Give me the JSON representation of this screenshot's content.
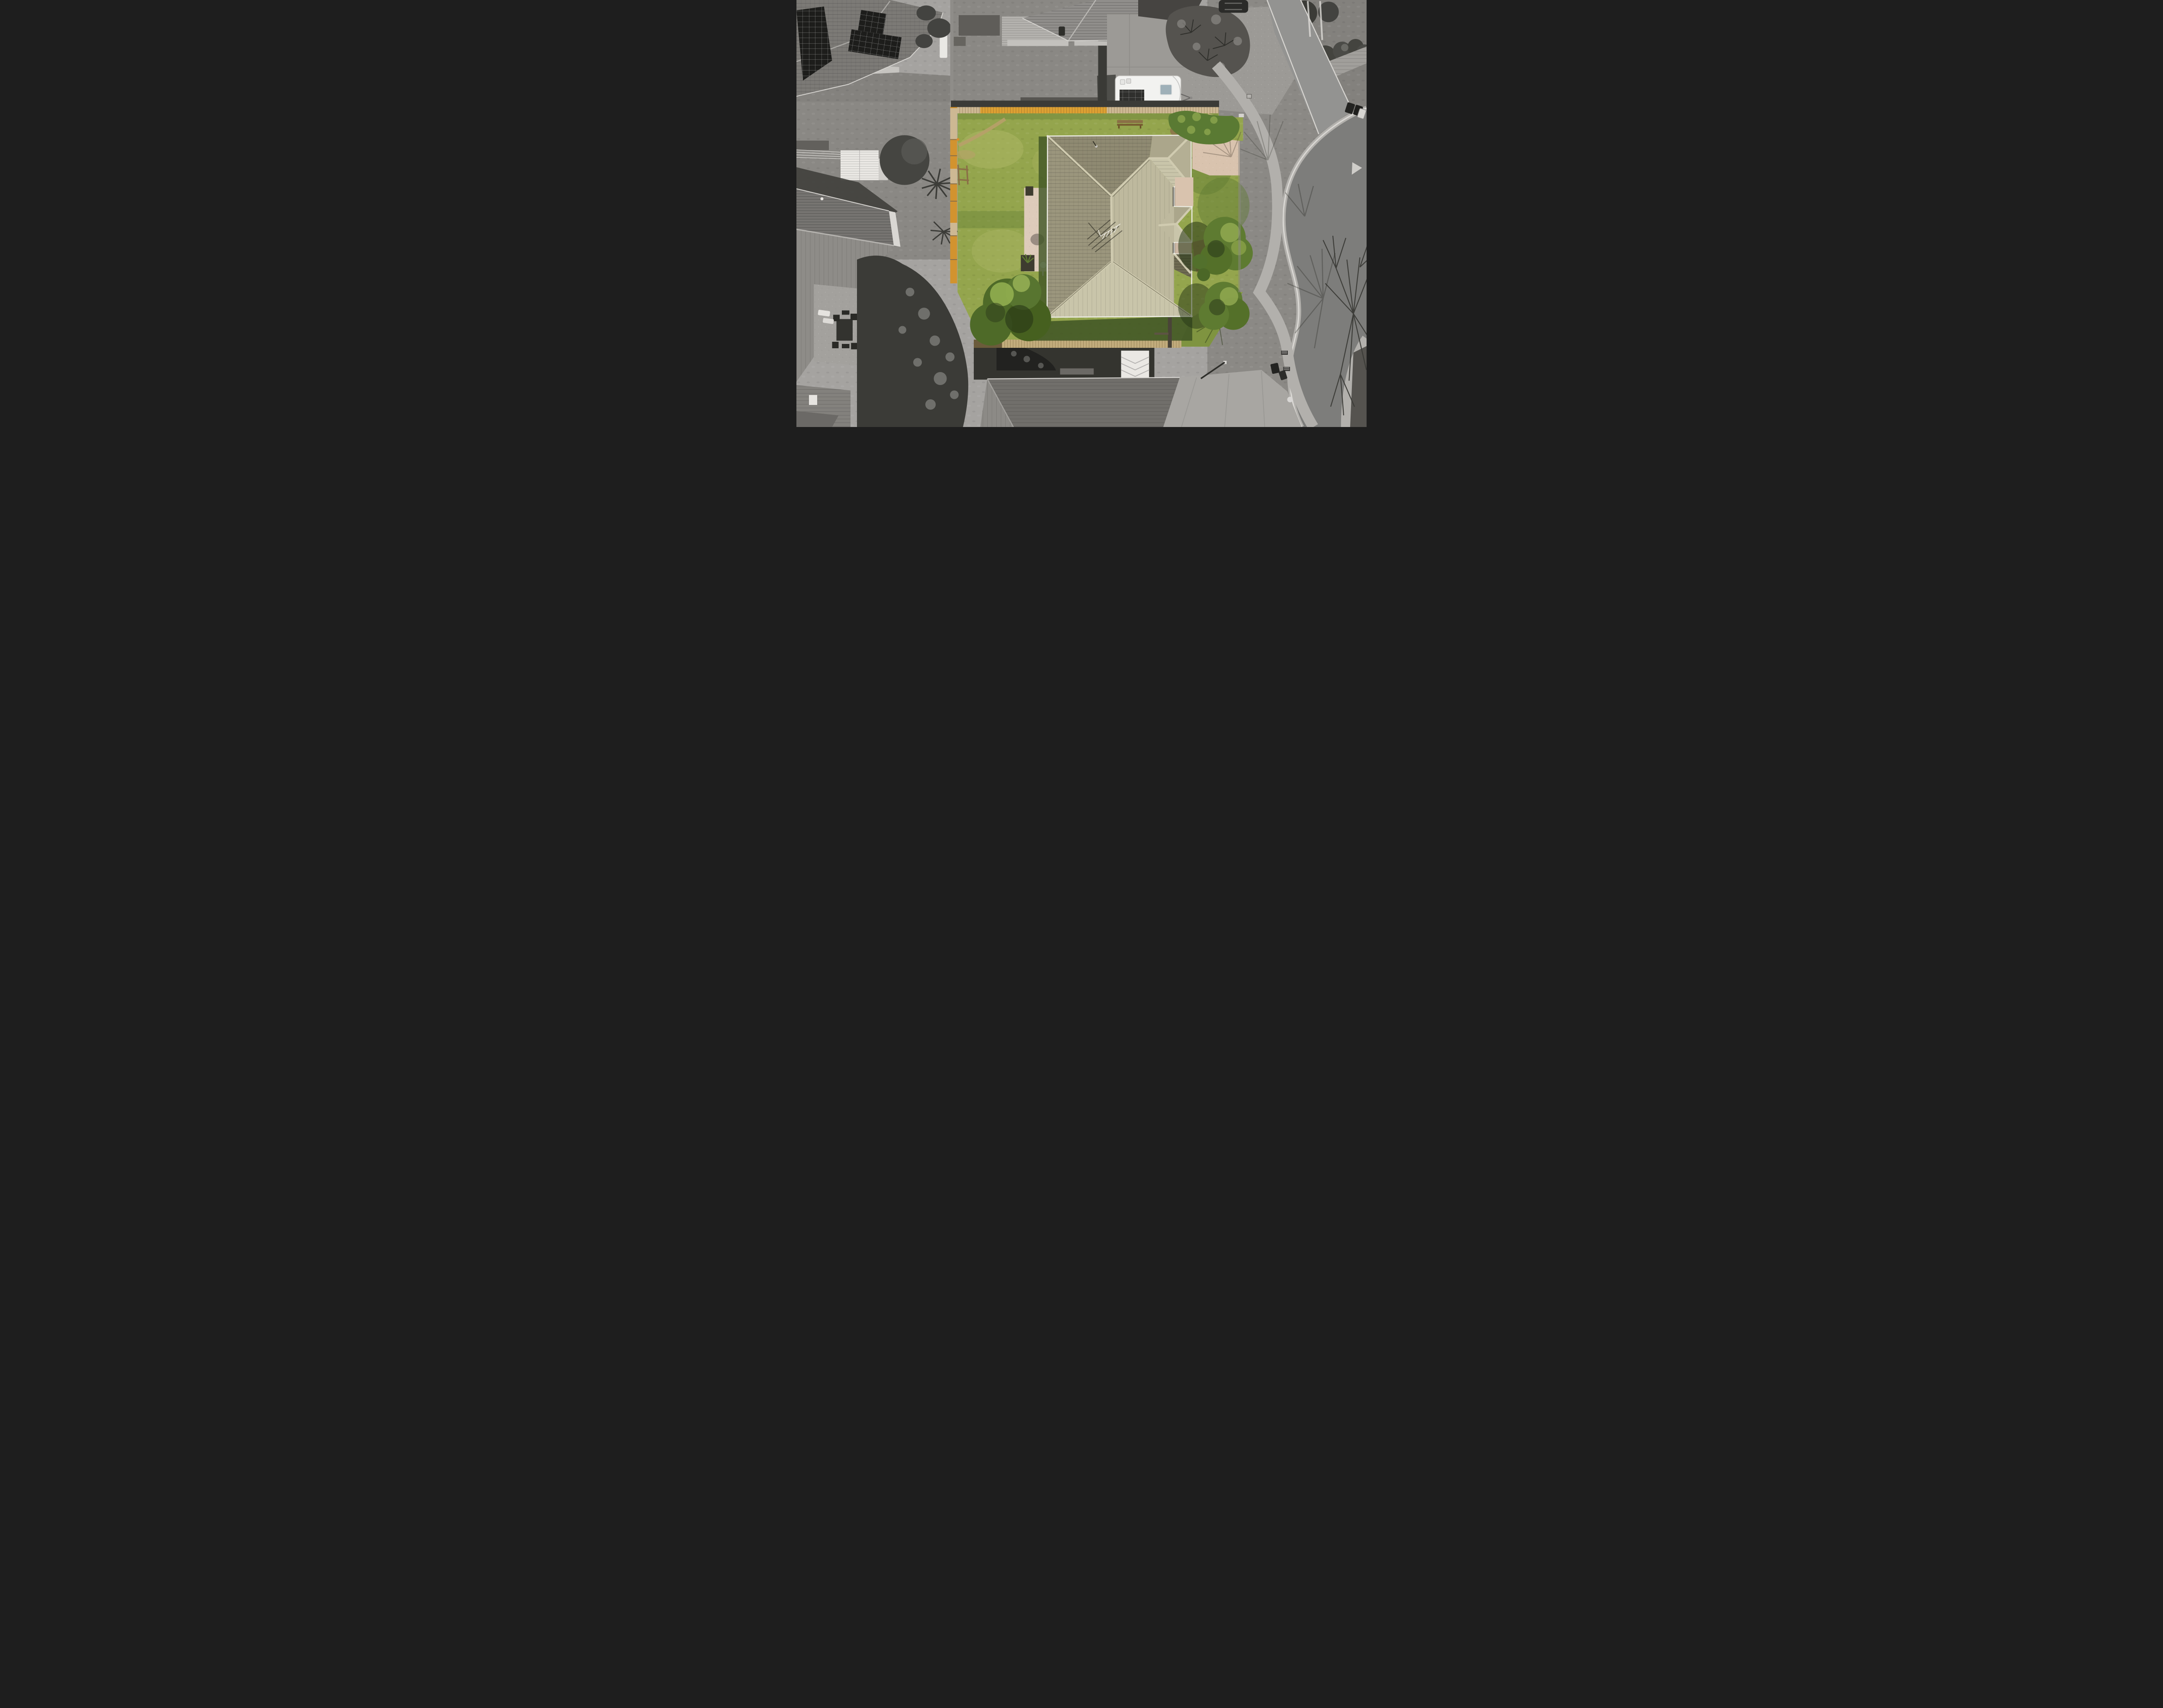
{
  "scene": {
    "type": "aerial-drone-photograph",
    "treatment": "top-down real-estate aerial; subject lot rendered in colour, surrounding neighbourhood desaturated grayscale",
    "subject_lot": {
      "lawn": "large green back lawn with worn dirt track",
      "house": "hip-roofed single storey home with khaki concrete tile roof, three east-side roof projections, TV antenna shadow",
      "boundary": "timber fence with orange lichen on left and top, timber boardwalk along bottom",
      "features": [
        "exposed-aggregate patio with planters and satellite dish",
        "two large clipped shrubs on east side",
        "corner hedge",
        "garden bench",
        "green wheelie bin",
        "orange ball on lawn"
      ]
    },
    "surroundings": [
      "neighbour house with rooftop solar panels (top-left)",
      "white motorhome on concrete pad (top-centre)",
      "kidney-shaped garden bed (top-right)",
      "curved suburban road with kerb, footpath and berm (right)",
      "large bare deciduous tree with branch shadows over road (bottom-right)",
      "neighbour backyard with white shed and clothesline (left)",
      "patio with outdoor table set (bottom-left)",
      "dark tiled neighbour roofs (bottom)"
    ]
  },
  "colors": {
    "base_concrete": "#a5a3a0",
    "concrete_light": "#b6b4b0",
    "concrete_pad": "#9c9a96",
    "road_asphalt": "#7d7d7b",
    "road_upper": "#939391",
    "curb": "#dad8d4",
    "channel": "#b3b1ad",
    "footpath": "#b2b0ac",
    "berm_grass": "#8b8985",
    "gray_lawn": "#8a8884",
    "gray_lawn_dark": "#6c6a66",
    "shadow_dark": "#393935",
    "gray_roof_tl": "#7c7a76",
    "gray_roof_tc": "#908e8b",
    "gray_roof_bl_dark": "#767471",
    "gray_roof_bl_light": "#8e8c88",
    "gray_roof_bc": "#716f6b",
    "corrugated_roof": "#a19f9b",
    "garage_roof": "#83817d",
    "gable_wall": "#d9d7d3",
    "deck_wood": "#b4b2ae",
    "paver": "#c6c4c0",
    "shed_white": "#eae8e4",
    "tree_dark": "#3b3b37",
    "tree_mid": "#5b5b57",
    "palm_dark": "#434340",
    "solar_dark": "#1d1d1b",
    "caravan_body": "#f2f2f0",
    "caravan_solar": "#2f2f2d",
    "caravan_window": "#9fb0b8",
    "garden_bed": "#55534f",
    "car_dark": "#2b2b29",
    "bin_dark": "#232321",
    "bin_white": "#d7d5d1",
    "lawn_green": "#94a54d",
    "lawn_light": "#adb766",
    "lawn_dark": "#5f7a33",
    "lawn_shadow": "#3e5424",
    "grass_shaded_right": "#7f9440",
    "dirt_path": "#b7a069",
    "dirt_bed": "#8a6b48",
    "fence_pale": "#cdb893",
    "fence_lichen": "#dda033",
    "fence_orange": "#d2932f",
    "boardwalk": "#c2ac7c",
    "roof_west": "#9b967d",
    "roof_north": "#8f8a72",
    "roof_east": "#beb99e",
    "roof_south": "#c9c5aa",
    "roof_wing": "#aba68b",
    "roof_dark_plane": "#6e6a52",
    "ridge_cap": "#d0cbb0",
    "fascia": "#edece4",
    "patio": "#ddcbba",
    "planter": "#3e3c2f",
    "bush_green": "#5e7b31",
    "bush_light": "#94ac52",
    "bush_shadow": "#263616",
    "hedge_green": "#5a7a33",
    "dish_white": "#efeeea",
    "bench_wood": "#8a6f46",
    "bin_green": "#35452b",
    "ball_orange": "#d98a2b",
    "giveway_mark": "#cfcdc9"
  }
}
